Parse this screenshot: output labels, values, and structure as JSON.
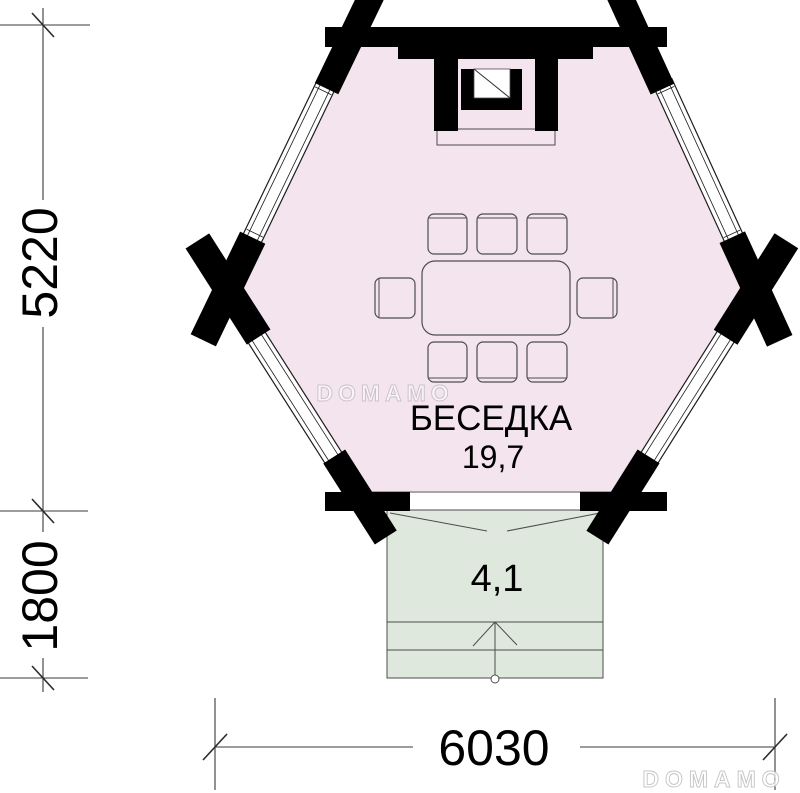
{
  "plan": {
    "room": {
      "name": "БЕСЕДКА",
      "area": "19,7"
    },
    "porch": {
      "area": "4,1"
    },
    "dimensions": {
      "left_upper": "5220",
      "left_lower": "1800",
      "bottom": "6030"
    },
    "watermarks": {
      "center": "DOMAMO",
      "corner": "DOMAMO"
    },
    "colors": {
      "room_fill": "#f3e4ee",
      "porch_fill": "#dfe8dc",
      "structure_black": "#000000",
      "furniture_line": "#4d4d4d"
    }
  }
}
